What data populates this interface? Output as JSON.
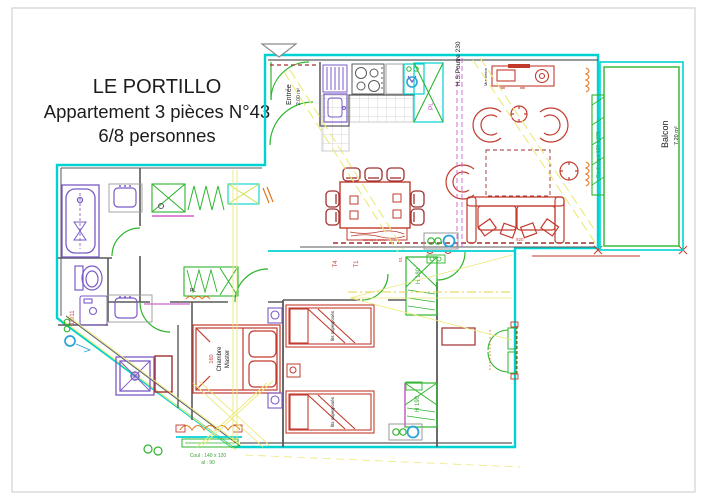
{
  "title": {
    "line1": "LE PORTILLO",
    "line2": "Appartement 3 pièces N°43",
    "line3": "6/8 personnes"
  },
  "rooms": {
    "entree": {
      "label": "Entrée",
      "area": "2.00 m²"
    },
    "balcon": {
      "label": "Balcon",
      "area": "7.20 m²"
    },
    "master_bedroom": {
      "bed_width": "160",
      "label_line1": "Chambre",
      "label_line2": "Master"
    },
    "bunk_room": {
      "bed1_label": "lits superposés",
      "bed2_label": "lits superposés"
    }
  },
  "annotations": {
    "beam": "H.S.Poutre 230",
    "sliding_door": "Coulissant 120 x 225",
    "concrete_wall": "Mur béton",
    "sofa_note": "canapé conv.",
    "sofa_dim": "920",
    "closet_kitchen": "Pl.",
    "closet_master": "PL",
    "closet_h180": "H 180",
    "closet_h190": "H 190",
    "type_t4": "T4",
    "type_t1": "T1",
    "left_code": "10/11",
    "window_dim_line1": "Coul : 140 x 120",
    "window_dim_line2": "al : 90"
  },
  "colors": {
    "wall_cyan": "#00d2d2",
    "door_green": "#2db52d",
    "fixture_purple": "#7b5bc7",
    "furniture_red": "#c23b2e",
    "accent_magenta": "#cf5fcf",
    "hatch_yellow": "#ece97a",
    "shutter_orange": "#e07820",
    "symbol_blue": "#2aa3d8",
    "tile_gray": "#c8c8c8",
    "text_black": "#1c1c1c"
  }
}
